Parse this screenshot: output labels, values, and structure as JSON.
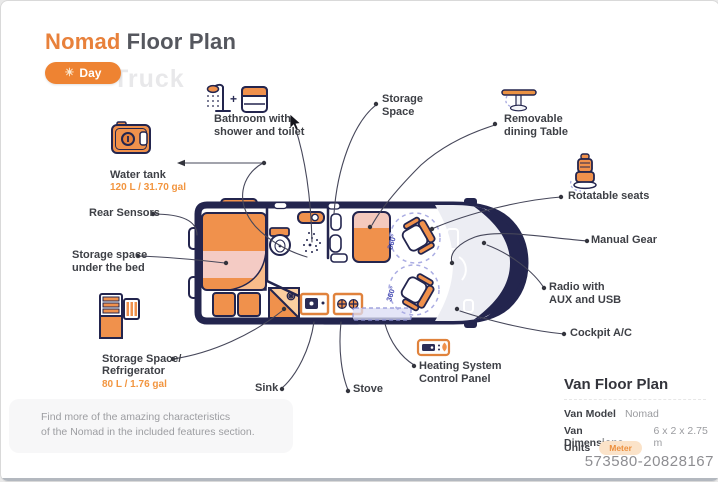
{
  "header": {
    "title_accent": "Nomad",
    "title_rest": "Floor Plan",
    "mode_button": "Day",
    "watermark_text": "Truck"
  },
  "plan_labels": {
    "bathroom": "Bathroom with\nshower and toilet",
    "bathroom_plus": "+",
    "storage_space": "Storage\nSpace",
    "removable_table": "Removable\ndining Table",
    "water_tank": "Water tank",
    "water_tank_value": "120 L / 31.70 gal",
    "rear_sensors": "Rear Sensors",
    "storage_under_bed": "Storage space\nunder the bed",
    "rotatable_seats": "Rotatable seats",
    "manual_gear": "Manual Gear",
    "radio": "Radio with\nAUX and USB",
    "fridge": "Storage Space/\nRefrigerator",
    "fridge_value": "80 L / 1.76 gal",
    "cockpit_ac": "Cockpit A/C",
    "sink": "Sink",
    "stove": "Stove",
    "heating": "Heating System\nControl Panel"
  },
  "floor_plan": {
    "rotation_labels": [
      "360°",
      "360°"
    ]
  },
  "info_panel": {
    "title": "Van Floor Plan",
    "rows": [
      {
        "label": "Van Model",
        "value": "Nomad"
      },
      {
        "label": "Van Dimensions",
        "value": "6 x 2 x 2.75 m"
      },
      {
        "label": "Units",
        "value": "Meter"
      }
    ]
  },
  "note": "Find more of the amazing characteristics\nof the Nomad in the included features section.",
  "footer_id": "573580-20828167",
  "colors": {
    "accent_orange": "#F0914C",
    "navy": "#23254E",
    "pink_band": "#F4CBC4",
    "rotation_blue": "#4B50B5"
  }
}
